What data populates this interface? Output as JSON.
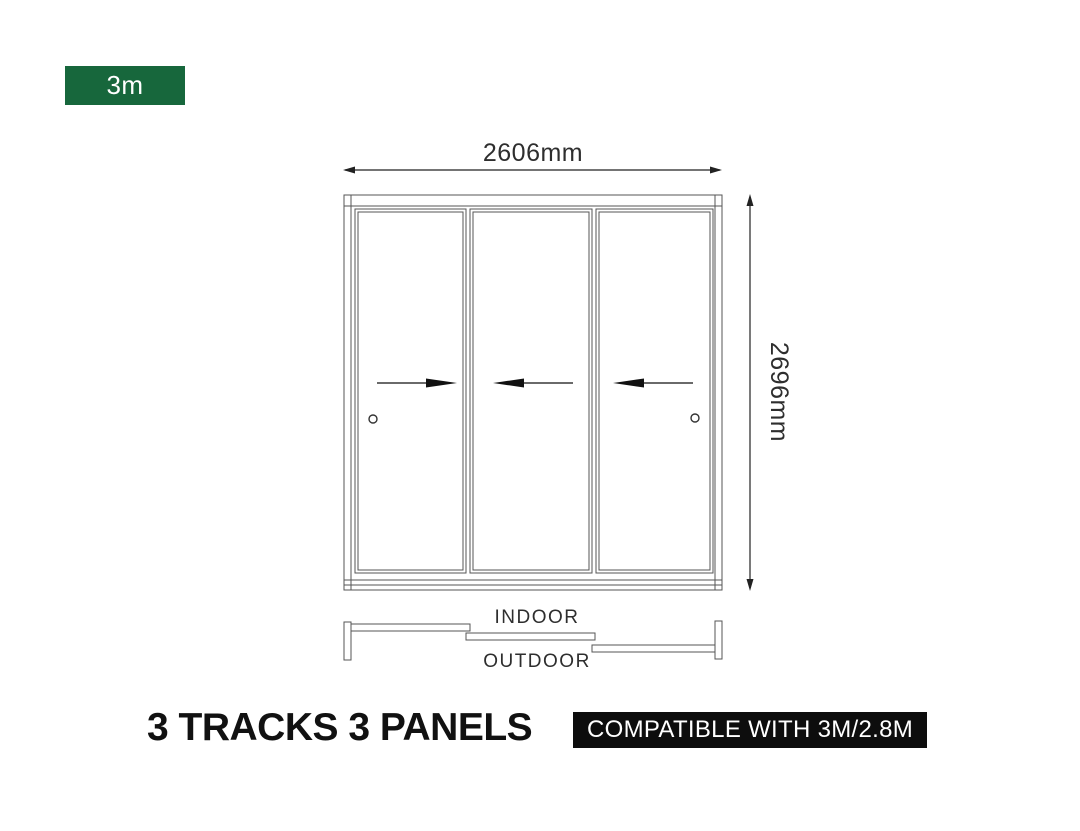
{
  "size_badge": {
    "label": "3m"
  },
  "diagram": {
    "width_dimension": "2606mm",
    "height_dimension": "2696mm",
    "panels": [
      {
        "id": 1,
        "slide_direction": "right",
        "has_handle": true
      },
      {
        "id": 2,
        "slide_direction": "left",
        "has_handle": false
      },
      {
        "id": 3,
        "slide_direction": "left",
        "has_handle": true
      }
    ],
    "plan": {
      "indoor_label": "INDOOR",
      "outdoor_label": "OUTDOOR",
      "tracks": 3
    }
  },
  "footer": {
    "title": "3 TRACKS 3 PANELS",
    "compatibility": "COMPATIBLE WITH 3M/2.8M"
  },
  "colors": {
    "accent_green": "#17673C",
    "badge_black": "#0D0D0D",
    "frame_line": "#555555",
    "dimension_line": "#222222",
    "text": "#2E2E2E",
    "background": "#FFFFFF"
  }
}
